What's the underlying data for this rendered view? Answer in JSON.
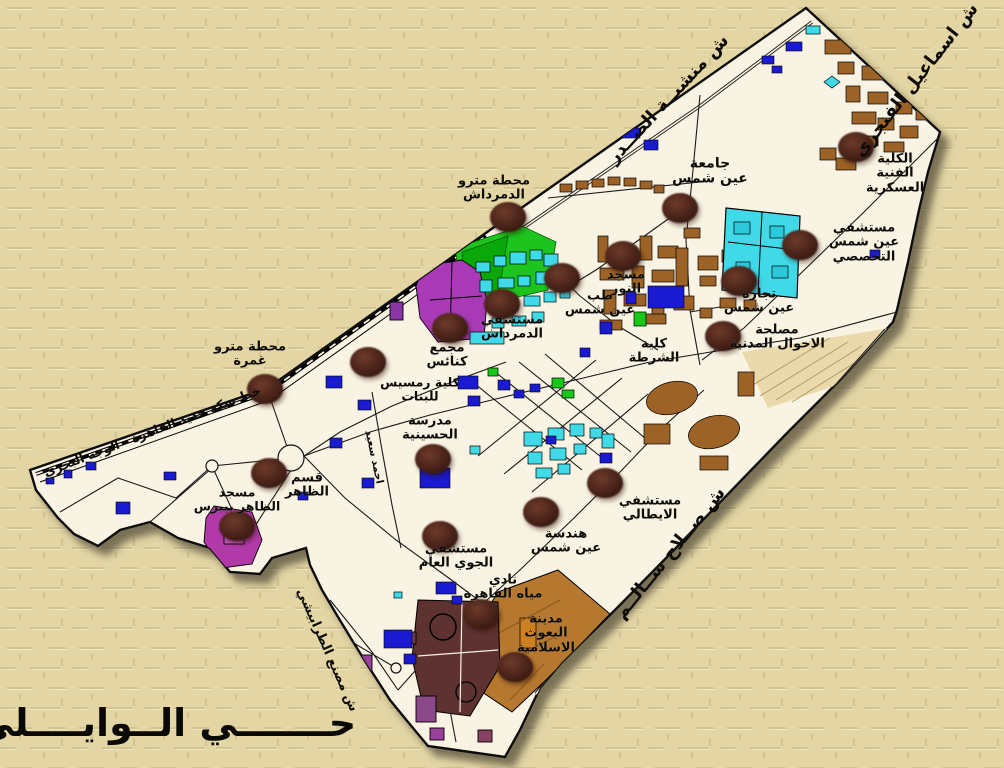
{
  "district": {
    "text": "حـــــــي الــوايــــلي",
    "x": 166,
    "y": 723,
    "size": 38
  },
  "colors": {
    "background_tan": "#e3d5a4",
    "district_fill": "#f8f3e2",
    "outline_black": "#111111",
    "marker_brown": "#4a241a",
    "park_green": "#1ec41e",
    "hospital_cyan": "#3fd9e8",
    "building_brown": "#9c6226",
    "building_blue": "#1a1ad0",
    "building_purple": "#a83bb5",
    "building_maroon": "#5d3230",
    "missions_tan": "#b5782e"
  },
  "streets": [
    {
      "id": "ismail-el-fangary",
      "text": "ش اسماعيل الفنجري",
      "x": 916,
      "y": 80,
      "rotate": -52,
      "size": 18
    },
    {
      "id": "manshiyet-el-sadr",
      "text": "ش منشيــة الصــدر",
      "x": 668,
      "y": 99,
      "rotate": -47,
      "size": 18
    },
    {
      "id": "salah-salem",
      "text": "ش صــلاح ســالــم",
      "x": 670,
      "y": 553,
      "rotate": -51,
      "size": 18
    },
    {
      "id": "cairo-railway-line",
      "text": "خط سكة حديد القاهرة - الوجه البحري",
      "x": 152,
      "y": 431,
      "rotate": -21,
      "size": 12.5
    },
    {
      "id": "tarabishi-factory",
      "text": "ش مصنع الطرابيشي",
      "x": 327,
      "y": 650,
      "rotate": 66,
      "size": 13
    },
    {
      "id": "ahmed-said",
      "text": "احمد سعيد",
      "x": 374,
      "y": 457,
      "rotate": 78,
      "size": 10.5
    }
  ],
  "pois": [
    {
      "id": "military-technical-college",
      "text": "الكلية\nالفنية\nالعسكرية",
      "x": 895,
      "y": 174,
      "size": 13
    },
    {
      "id": "ain-shams-university",
      "text": "جامعة\nعين شمس",
      "x": 710,
      "y": 172,
      "size": 14
    },
    {
      "id": "demerdash-metro",
      "text": "محطة مترو\nالدمرداش",
      "x": 494,
      "y": 189,
      "size": 13
    },
    {
      "id": "ain-shams-specialized-hospital",
      "text": "مستشفي\nعين شمس\nالتخصصي",
      "x": 864,
      "y": 243,
      "size": 13
    },
    {
      "id": "nour-mosque",
      "text": "مسجد\nالنور",
      "x": 626,
      "y": 283,
      "size": 13
    },
    {
      "id": "medicine-ain-shams",
      "text": "طب\nعين شمس",
      "x": 600,
      "y": 304,
      "size": 13
    },
    {
      "id": "demerdash-hospital",
      "text": "مستشفي\nالدمرداش",
      "x": 512,
      "y": 328,
      "size": 13
    },
    {
      "id": "churches-complex",
      "text": "مجمع\nكنائس",
      "x": 447,
      "y": 356,
      "size": 13
    },
    {
      "id": "ramses-college",
      "text": "كلية رمسيس\nللبنات",
      "x": 420,
      "y": 389,
      "size": 12.5
    },
    {
      "id": "commerce-ain-shams",
      "text": "تجارة\nعين شمس",
      "x": 759,
      "y": 302,
      "size": 13
    },
    {
      "id": "civil-status-authority",
      "text": "مصلحة\nالاحوال المدنية",
      "x": 777,
      "y": 338,
      "size": 13
    },
    {
      "id": "police-college",
      "text": "كلية\nالشرطة",
      "x": 654,
      "y": 352,
      "size": 13
    },
    {
      "id": "ghamra-metro",
      "text": "محطة مترو\nغمرة",
      "x": 250,
      "y": 355,
      "size": 13
    },
    {
      "id": "husseiniya-school",
      "text": "مدرسة\nالحسينية",
      "x": 430,
      "y": 429,
      "size": 13
    },
    {
      "id": "zaher-police-station",
      "text": "قسم\nالظاهر",
      "x": 307,
      "y": 486,
      "size": 13
    },
    {
      "id": "baybars-mosque",
      "text": "مسجد\nالظاهر بيبرس",
      "x": 237,
      "y": 499,
      "size": 12.5
    },
    {
      "id": "italian-hospital",
      "text": "مستشفي\nالايطالي",
      "x": 650,
      "y": 509,
      "size": 13
    },
    {
      "id": "engineering-ain-shams",
      "text": "هندسة\nعين شمس",
      "x": 566,
      "y": 542,
      "size": 13
    },
    {
      "id": "air-force-hospital",
      "text": "مستشفي\nالجوي العام",
      "x": 456,
      "y": 557,
      "size": 13
    },
    {
      "id": "cairo-water-club",
      "text": "نادي\nمياه القاهرة",
      "x": 503,
      "y": 588,
      "size": 13
    },
    {
      "id": "islamic-missions-city",
      "text": "مدينة\nالبعوث\nالاسلامية",
      "x": 546,
      "y": 634,
      "size": 13
    }
  ],
  "markers": [
    {
      "ref": "military-technical-college",
      "x": 856,
      "y": 147
    },
    {
      "ref": "ain-shams-university",
      "x": 680,
      "y": 208
    },
    {
      "ref": "medicine-ain-shams",
      "x": 623,
      "y": 256
    },
    {
      "ref": "demerdash-metro",
      "x": 508,
      "y": 217
    },
    {
      "ref": "nour-mosque",
      "x": 562,
      "y": 278
    },
    {
      "ref": "ain-shams-specialized-hospital",
      "x": 800,
      "y": 245
    },
    {
      "ref": "commerce-ain-shams",
      "x": 739,
      "y": 281
    },
    {
      "ref": "civil-status-authority",
      "x": 723,
      "y": 336
    },
    {
      "ref": "demerdash-hospital",
      "x": 502,
      "y": 304
    },
    {
      "ref": "churches-complex",
      "x": 450,
      "y": 328
    },
    {
      "ref": "ramses-college",
      "x": 368,
      "y": 362
    },
    {
      "ref": "ghamra-metro",
      "x": 265,
      "y": 389
    },
    {
      "ref": "husseiniya-school",
      "x": 433,
      "y": 459
    },
    {
      "ref": "zaher-police-station",
      "x": 269,
      "y": 473
    },
    {
      "ref": "baybars-mosque",
      "x": 237,
      "y": 526
    },
    {
      "ref": "italian-hospital",
      "x": 605,
      "y": 483
    },
    {
      "ref": "engineering-ain-shams",
      "x": 541,
      "y": 512
    },
    {
      "ref": "air-force-hospital",
      "x": 440,
      "y": 536
    },
    {
      "ref": "cairo-water-club",
      "x": 481,
      "y": 614
    },
    {
      "ref": "islamic-missions-city",
      "x": 515,
      "y": 667
    }
  ]
}
